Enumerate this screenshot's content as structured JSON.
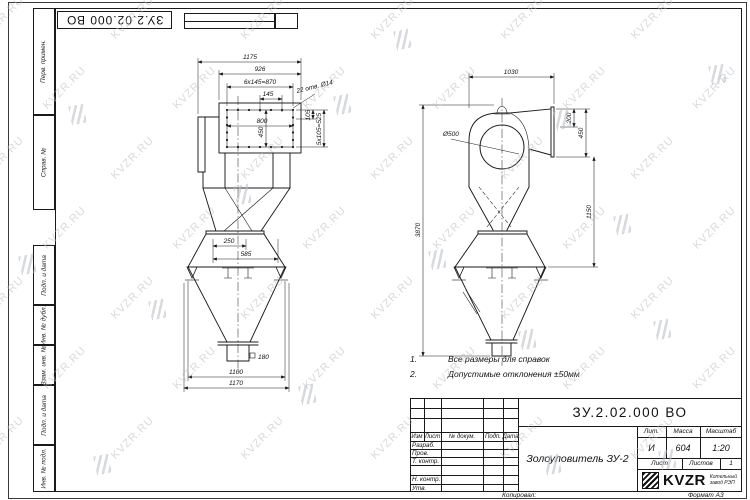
{
  "colors": {
    "paper": "#ffffff",
    "line": "#1a1a1a",
    "watermark": "#b7bbc1"
  },
  "watermark": {
    "text": "KVZR.RU"
  },
  "stamp_top": {
    "doc_number": "ЗУ.2.02.000 ВО"
  },
  "margin": {
    "labels": [
      "Перв. примен.",
      "Справ. №",
      "Подп. и дата",
      "Инв. № дубл.",
      "Взам. инв. №",
      "Подп. и дата",
      "Инв. № подл."
    ]
  },
  "front_view": {
    "dim_overall_width": "1175",
    "dim_flange_width": "926",
    "dim_hole_row": "6x145=870",
    "dim_hole_pitch": "145",
    "holes_note": "22 отв. Ø14",
    "dim_opening_width": "800",
    "dim_opening_height": "450",
    "dim_hole_v": "105",
    "dim_hole_col": "5x105=525",
    "dim_ring_offset": "250",
    "dim_ring_width": "585",
    "dim_outlet_square": "180",
    "dim_base_width": "1100",
    "dim_base_overall": "1170"
  },
  "side_view": {
    "dim_overall_depth": "1030",
    "dim_scroll_dia": "Ø500",
    "dim_duct_offset": "200",
    "dim_duct_height": "450",
    "dim_cone_height": "1150",
    "dim_overall_height": "3870"
  },
  "notes": [
    {
      "num": "1.",
      "text": "Все размеры для справок"
    },
    {
      "num": "2.",
      "text": "Допустимые отклонения ±50мм"
    }
  ],
  "title_block": {
    "doc_number": "ЗУ.2.02.000 ВО",
    "title": "Золоуловитель ЗУ-2",
    "change_cols": [
      "Изм",
      "Лист",
      "№ докум.",
      "Подп.",
      "Дата"
    ],
    "roles": [
      "Разраб.",
      "Пров.",
      "Т. контр.",
      "Н. контр.",
      "Утв."
    ],
    "lit_label": "Лит.",
    "lit_value": "И",
    "mass_label": "Масса",
    "mass_value": "604",
    "scale_label": "Масштаб",
    "scale_value": "1:20",
    "sheet_label": "Лист",
    "sheets_label": "Листов",
    "sheets_value": "1",
    "logo_text": "KVZR",
    "logo_caption_line1": "Котельный",
    "logo_caption_line2": "завод РЭП",
    "copied_label": "Копировал:",
    "format_label": "Формат А3"
  }
}
